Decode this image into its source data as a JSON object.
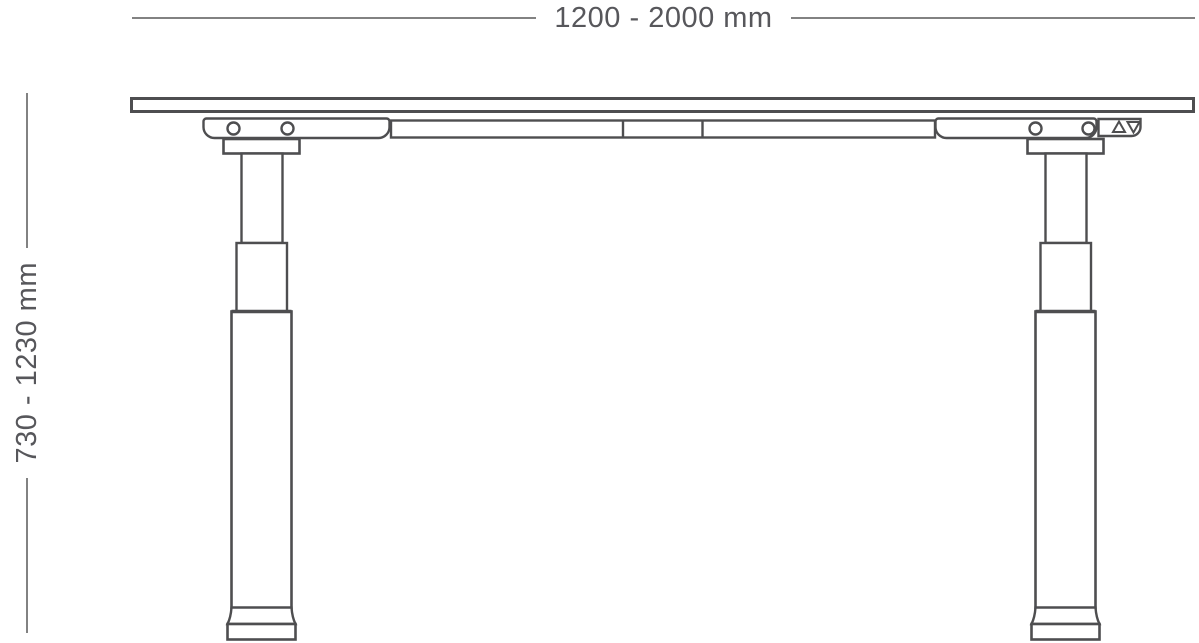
{
  "diagram": {
    "title": "height-adjustable desk side elevation",
    "width_dimension": {
      "label": "1200 - 2000 mm"
    },
    "height_dimension": {
      "label": "730 - 1230 mm"
    },
    "control": {
      "up_icon": "triangle-up",
      "down_icon": "triangle-down"
    },
    "legs": {
      "count": 2,
      "stages_per_leg": 3,
      "screw_holes_per_rail": 2
    }
  },
  "colors": {
    "outline": "#4e4e50",
    "dimension_line": "#828282",
    "dimension_text": "#57575b",
    "background": "#ffffff"
  }
}
